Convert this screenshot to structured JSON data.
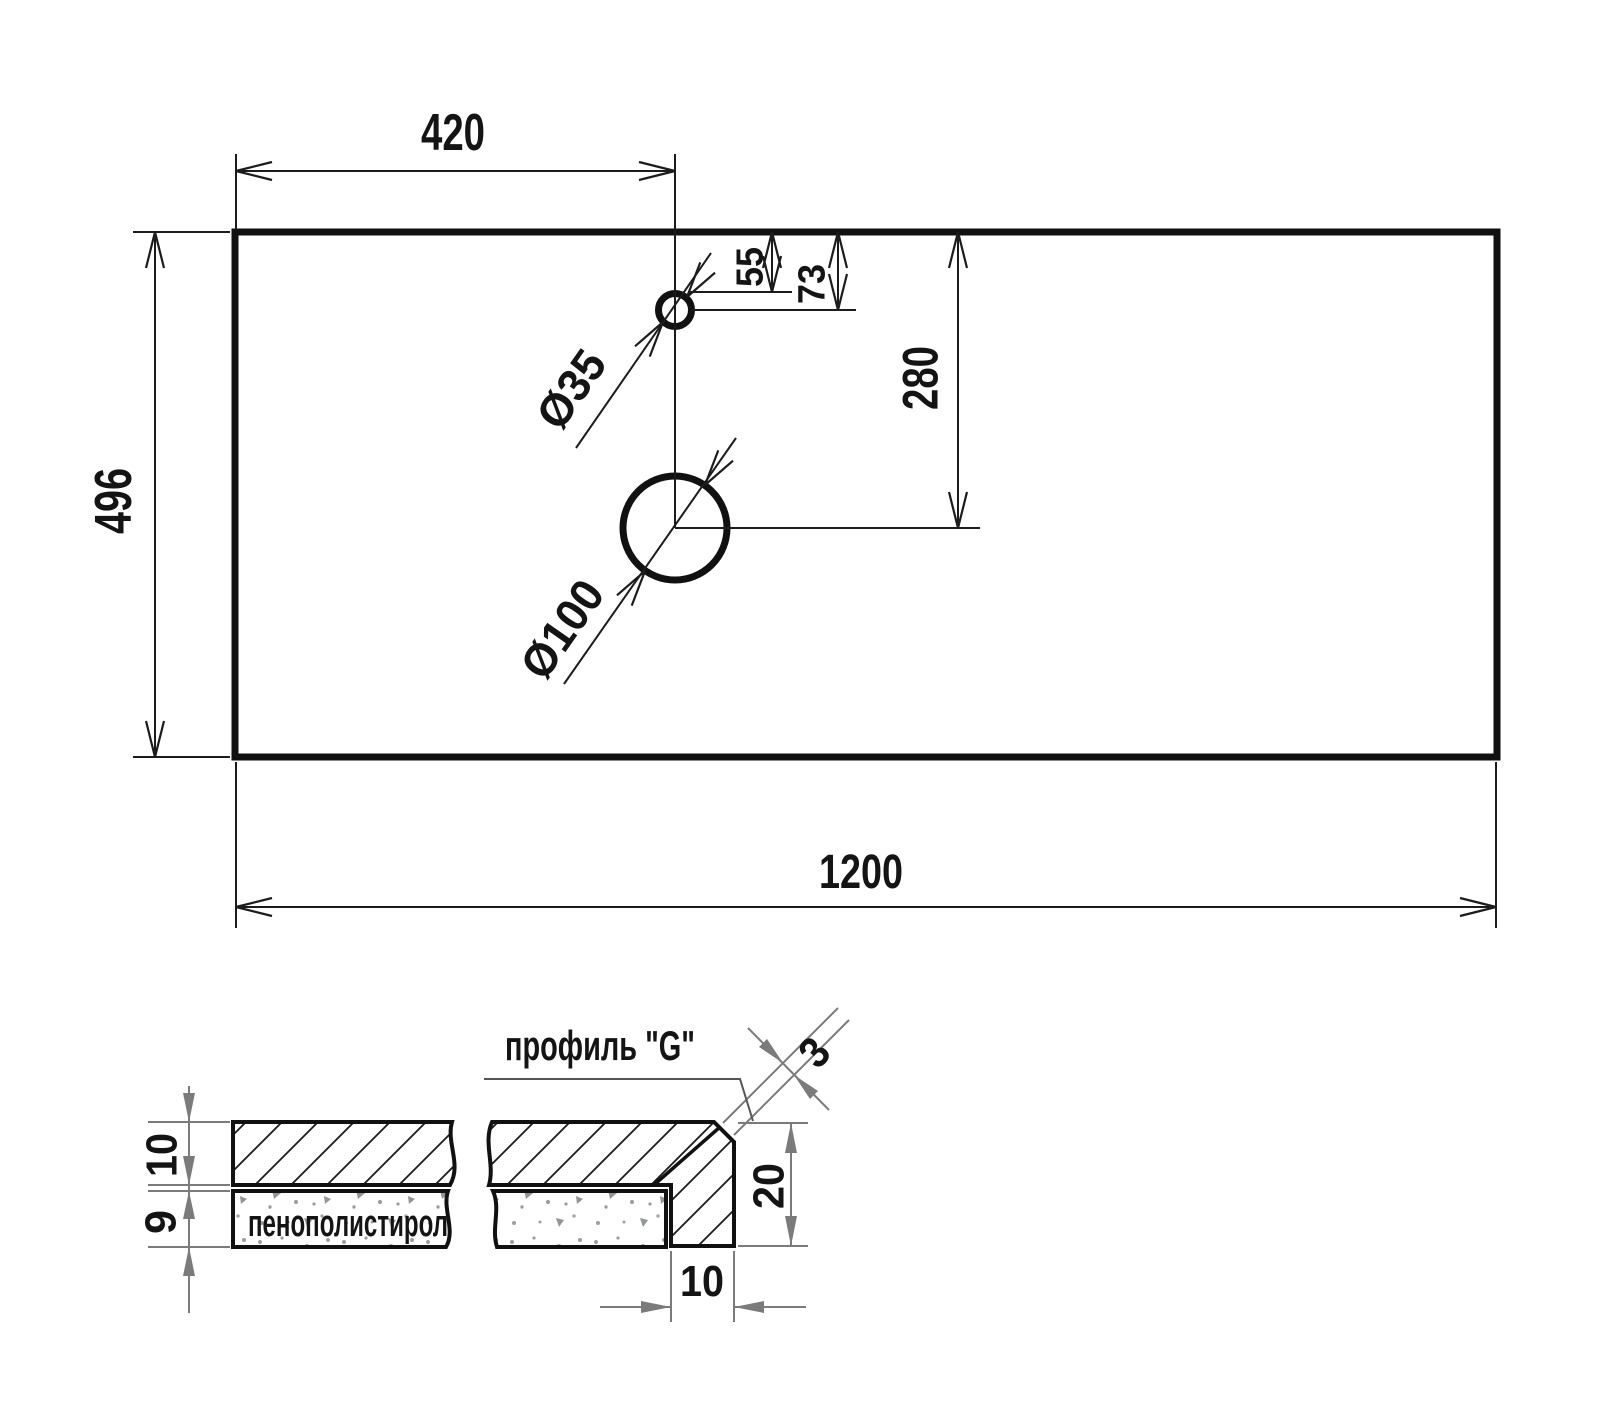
{
  "top_view": {
    "width": "1200",
    "height": "496",
    "hole_center_from_left": "420",
    "small_hole_top_clearance": "55",
    "small_hole_center_from_top": "73",
    "large_hole_center_from_top": "280",
    "small_hole_diameter": "Ø35",
    "large_hole_diameter": "Ø100"
  },
  "section_view": {
    "title": "профиль \"G\"",
    "foam_label": "пенополистирол",
    "top_layer_thickness": "10",
    "foam_layer_thickness": "9",
    "edge_profile_height": "20",
    "edge_profile_width": "10",
    "chamfer_size": "3"
  },
  "colors": {
    "line": "#141414",
    "dimension_gray": "#7b7b7b",
    "background": "#ffffff"
  }
}
